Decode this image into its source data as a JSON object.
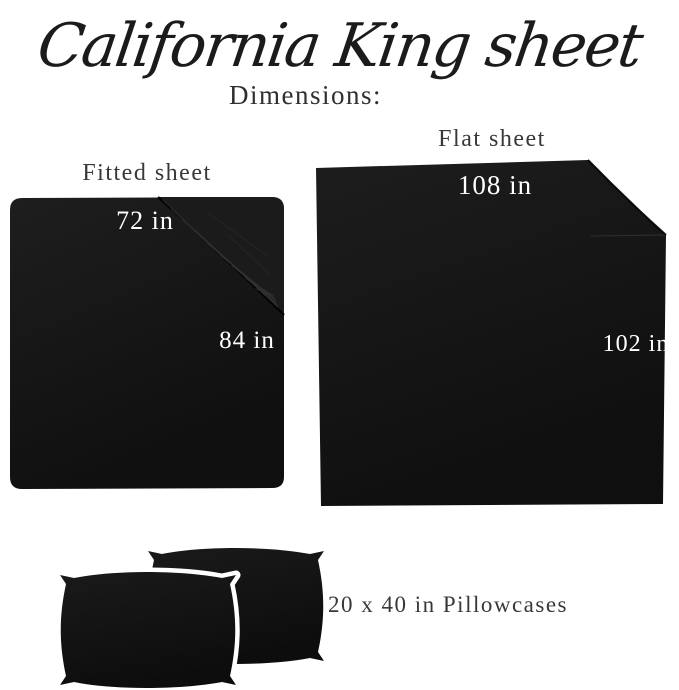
{
  "title": "California King sheet",
  "subtitle": "Dimensions:",
  "colors": {
    "background": "#ffffff",
    "fabric_dark": "#151515",
    "fabric_light": "#1c1c1c",
    "label_text": "#383838",
    "dimension_text": "#ffffff",
    "title_text": "#1b1b1b"
  },
  "fitted_sheet": {
    "label": "Fitted sheet",
    "width_label": "72 in",
    "length_label": "84 in"
  },
  "flat_sheet": {
    "label": "Flat sheet",
    "width_label": "108 in",
    "length_label": "102 in"
  },
  "pillowcases": {
    "label": "20 x 40 in Pillowcases"
  }
}
